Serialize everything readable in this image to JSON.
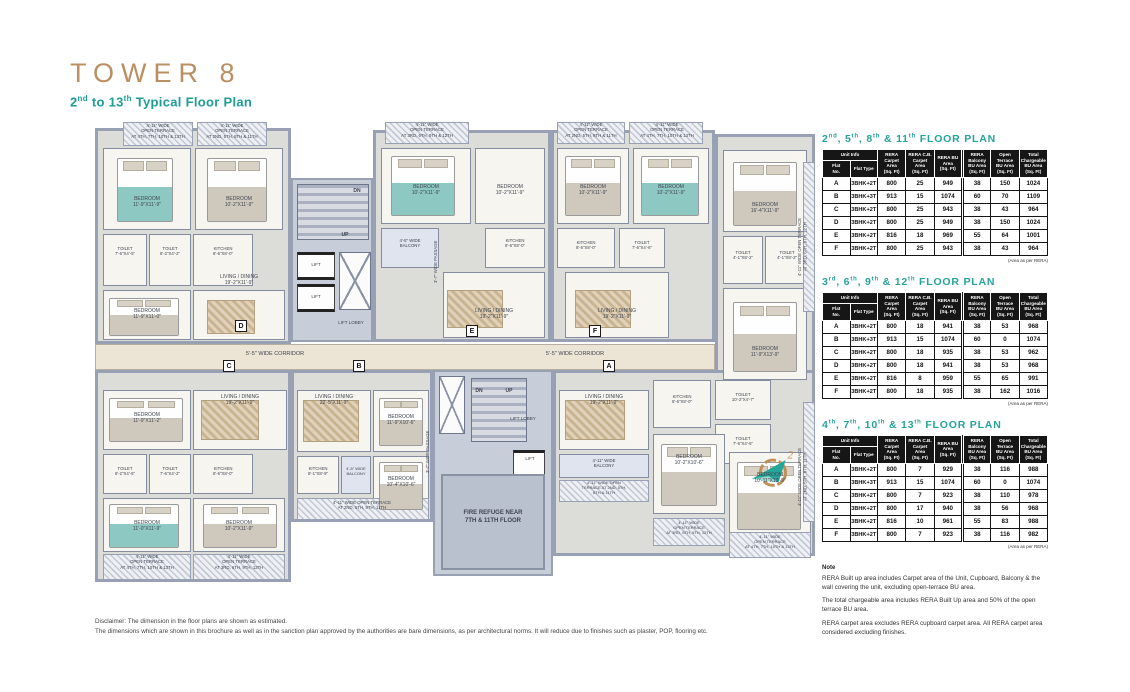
{
  "header": {
    "title": "TOWER 8",
    "subtitle_segments": [
      {
        "t": "2"
      },
      {
        "t": "nd",
        "sup": true
      },
      {
        "t": " to 13"
      },
      {
        "t": "th",
        "sup": true
      },
      {
        "t": " Typical Floor Plan"
      }
    ]
  },
  "floor_plan": {
    "unit_markers": [
      {
        "l": "D",
        "x": 140,
        "y": 198
      },
      {
        "l": "E",
        "x": 371,
        "y": 203
      },
      {
        "l": "F",
        "x": 494,
        "y": 203
      },
      {
        "l": "C",
        "x": 128,
        "y": 238
      },
      {
        "l": "B",
        "x": 258,
        "y": 238
      },
      {
        "l": "A",
        "x": 508,
        "y": 238
      }
    ],
    "labels": [
      {
        "t": "4'-11\" WIDE\nOPEN TERRACE\nAT 4TH, 7TH, 10TH & 13TH",
        "x": 28,
        "y": 1,
        "w": 70,
        "fs": 4.3
      },
      {
        "t": "4'-11\" WIDE\nOPEN TERRACE\nAT 2ND, 5TH, 8TH & 11TH",
        "x": 102,
        "y": 1,
        "w": 70,
        "fs": 4.3
      },
      {
        "t": "BEDROOM\n11'-9\"X11'-9\"",
        "x": 10,
        "y": 74,
        "w": 84
      },
      {
        "t": "BEDROOM\n10'-2\"X11'-9\"",
        "x": 102,
        "y": 74,
        "w": 84
      },
      {
        "t": "TOILET\n7'-6\"X4'-5\"",
        "x": 8,
        "y": 124,
        "w": 44,
        "fs": 4.3
      },
      {
        "t": "TOILET\n8'-2\"X4'-2\"",
        "x": 54,
        "y": 124,
        "w": 42,
        "fs": 4.3
      },
      {
        "t": "KITCHEN\n8'-6\"X8'-0\"",
        "x": 98,
        "y": 124,
        "w": 60,
        "fs": 4.3
      },
      {
        "t": "BEDROOM\n11'-9\"X11'-0\"",
        "x": 10,
        "y": 186,
        "w": 84
      },
      {
        "t": "LIVING / DINING\n19'-2\"X11'-9\"",
        "x": 98,
        "y": 152,
        "w": 92
      },
      {
        "t": "DN",
        "x": 252,
        "y": 66,
        "w": 20,
        "b": true
      },
      {
        "t": "UP",
        "x": 240,
        "y": 110,
        "w": 20,
        "b": true
      },
      {
        "t": "LIFT",
        "x": 202,
        "y": 140,
        "w": 38,
        "fs": 4.5
      },
      {
        "t": "LIFT",
        "x": 202,
        "y": 172,
        "w": 38,
        "fs": 4.5
      },
      {
        "t": "LIFT LOBBY",
        "x": 232,
        "y": 198,
        "w": 48,
        "fs": 4.5
      },
      {
        "t": "4'-11\" WIDE\nOPEN TERRACE\nAT 3RD, 6TH, 9TH & 12TH",
        "x": 288,
        "y": 0,
        "w": 88,
        "fs": 4.3
      },
      {
        "t": "BEDROOM\n10'-2\"X11'-9\"",
        "x": 288,
        "y": 62,
        "w": 86
      },
      {
        "t": "BEDROOM\n10'-2\"X11'-9\"",
        "x": 382,
        "y": 62,
        "w": 66
      },
      {
        "t": "4'-5\" WIDE\nBALCONY",
        "x": 286,
        "y": 116,
        "w": 58,
        "fs": 4.3
      },
      {
        "t": "KITCHEN\n8'-6\"X8'-0\"",
        "x": 390,
        "y": 116,
        "w": 60,
        "fs": 4.3
      },
      {
        "t": "LIVING / DINING\n19'-2\"X11'-9\"",
        "x": 348,
        "y": 186,
        "w": 102
      },
      {
        "t": "3'-7\" WIDE PASSAGE",
        "x": 338,
        "y": 100,
        "rot": true,
        "h": 80,
        "fs": 4.3
      },
      {
        "t": "4'-11\" WIDE\nOPEN TERRACE\nAT 2ND, 5TH, 8TH & 11TH",
        "x": 460,
        "y": 0,
        "w": 72,
        "fs": 4.3
      },
      {
        "t": "4'-11\" WIDE\nOPEN TERRACE\nAT 4TH, 7TH, 10TH & 13TH",
        "x": 534,
        "y": 0,
        "w": 76,
        "fs": 4.3
      },
      {
        "t": "BEDROOM\n10'-2\"X11'-9\"",
        "x": 464,
        "y": 62,
        "w": 68
      },
      {
        "t": "BEDROOM\n10'-2\"X11'-9\"",
        "x": 540,
        "y": 62,
        "w": 72
      },
      {
        "t": "KITCHEN\n8'-6\"X8'-0\"",
        "x": 462,
        "y": 118,
        "w": 58,
        "fs": 4.3
      },
      {
        "t": "TOILET\n7'-6\"X4'-6\"",
        "x": 524,
        "y": 118,
        "w": 46,
        "fs": 4.3
      },
      {
        "t": "LIVING / DINING\n19'-2\"X11'-9\"",
        "x": 470,
        "y": 186,
        "w": 104
      },
      {
        "t": "BEDROOM\n16'-4\"X11'-9\"",
        "x": 630,
        "y": 80,
        "w": 80
      },
      {
        "t": "TOILET\n4'-1\"X8'-2\"",
        "x": 628,
        "y": 128,
        "w": 40,
        "fs": 4.3
      },
      {
        "t": "TOILET\n4'-1\"X8'-2\"",
        "x": 670,
        "y": 128,
        "w": 44,
        "fs": 4.3
      },
      {
        "t": "BEDROOM\n11'-9\"X13'-9\"",
        "x": 630,
        "y": 224,
        "w": 80
      },
      {
        "t": "4'-11\" WIDE OPEN TERRACE\nAT 3RD, 6TH, 9TH, 12TH",
        "x": 702,
        "y": 60,
        "rot": true,
        "h": 130,
        "fs": 4.3
      },
      {
        "t": "5'-5\" WIDE CORRIDOR",
        "x": 120,
        "y": 229,
        "w": 120,
        "fs": 5.5
      },
      {
        "t": "5'-5\" WIDE CORRIDOR",
        "x": 420,
        "y": 229,
        "w": 120,
        "fs": 5.5
      },
      {
        "t": "BEDROOM\n11'-9\"X11'-2\"",
        "x": 10,
        "y": 290,
        "w": 84
      },
      {
        "t": "LIVING / DINING\n19'-2\"X11'-9\"",
        "x": 98,
        "y": 272,
        "w": 94
      },
      {
        "t": "TOILET\n8'-2\"X4'-5\"",
        "x": 8,
        "y": 344,
        "w": 44,
        "fs": 4.3
      },
      {
        "t": "TOILET\n7'-6\"X4'-2\"",
        "x": 54,
        "y": 344,
        "w": 42,
        "fs": 4.3
      },
      {
        "t": "KITCHEN\n8'-6\"X8'-0\"",
        "x": 98,
        "y": 344,
        "w": 60,
        "fs": 4.3
      },
      {
        "t": "BEDROOM\n11'-0\"X11'-9\"",
        "x": 10,
        "y": 398,
        "w": 84
      },
      {
        "t": "BEDROOM\n10'-2\"X11'-9\"",
        "x": 98,
        "y": 398,
        "w": 92
      },
      {
        "t": "4'-11\" WIDE\nOPEN TERRACE\nAT 4TH, 7TH, 10TH & 13TH",
        "x": 8,
        "y": 432,
        "w": 88,
        "fs": 4.3
      },
      {
        "t": "4'-11\" WIDE\nOPEN TERRACE\nAT 3RD, 6TH, 9TH, 12TH",
        "x": 98,
        "y": 432,
        "w": 92,
        "fs": 4.3
      },
      {
        "t": "LIVING / DINING\n22'-5\"X11'-9\"",
        "x": 200,
        "y": 272,
        "w": 78
      },
      {
        "t": "BEDROOM\n11'-9\"X10'-6\"",
        "x": 276,
        "y": 292,
        "w": 60
      },
      {
        "t": "KITCHEN\n8'-1\"X8'-9\"",
        "x": 200,
        "y": 344,
        "w": 46,
        "fs": 4.3
      },
      {
        "t": "4'-5\" WIDE\nBALCONY",
        "x": 244,
        "y": 344,
        "w": 34,
        "fs": 4
      },
      {
        "t": "BEDROOM\n10'-4\"X10'-6\"",
        "x": 276,
        "y": 354,
        "w": 60
      },
      {
        "t": "4'-11\" WIDE OPEN TERRACE\nAT 2ND, 5TH, 8TH, 11TH",
        "x": 200,
        "y": 378,
        "w": 134,
        "fs": 4.3
      },
      {
        "t": "3'-7\" WIDE PASSAGE",
        "x": 330,
        "y": 290,
        "rot": true,
        "h": 80,
        "fs": 4.3
      },
      {
        "t": "DN",
        "x": 374,
        "y": 266,
        "w": 20,
        "b": true
      },
      {
        "t": "UP",
        "x": 404,
        "y": 266,
        "w": 20,
        "b": true
      },
      {
        "t": "LIFT LOBBY",
        "x": 400,
        "y": 294,
        "w": 56,
        "fs": 4.5
      },
      {
        "t": "LIFT",
        "x": 420,
        "y": 334,
        "w": 30,
        "fs": 4.5
      },
      {
        "t": "FIRE REFUGE NEAR\n7TH & 11TH FLOOR",
        "x": 356,
        "y": 388,
        "w": 84,
        "fs": 6,
        "b": true
      },
      {
        "t": "LIVING / DINING\n19'-2\"X11'-9\"",
        "x": 462,
        "y": 272,
        "w": 94
      },
      {
        "t": "KITCHEN\n8'-6\"X8'-0\"",
        "x": 558,
        "y": 272,
        "w": 58,
        "fs": 4.3
      },
      {
        "t": "TOILET\n10'-2\"X4'-7\"",
        "x": 620,
        "y": 270,
        "w": 56,
        "fs": 4.3
      },
      {
        "t": "TOILET\n7'-6\"X4'-6\"",
        "x": 620,
        "y": 314,
        "w": 56,
        "fs": 4.3
      },
      {
        "t": "4'-11\" WIDE\nBALCONY",
        "x": 466,
        "y": 336,
        "w": 86,
        "fs": 4.3
      },
      {
        "t": "4'-11\" WIDE OPEN\nTERRACE AT 2ND, 5TH,\n8TH & 11TH",
        "x": 466,
        "y": 358,
        "w": 86,
        "fs": 4
      },
      {
        "t": "BEDROOM\n10'-2\"X10'-6\"",
        "x": 560,
        "y": 332,
        "w": 68
      },
      {
        "t": "BEDROOM\n10'-11\"X13'-9\"",
        "x": 636,
        "y": 350,
        "w": 78
      },
      {
        "t": "4'-11\" WIDE\nOPEN TERRACE\nAT 3RD, 6TH, 9TH, 12TH",
        "x": 558,
        "y": 398,
        "w": 72,
        "fs": 4
      },
      {
        "t": "4'-11\" WIDE\nOPEN TERRACE\nAT 4TH, 7TH, 10TH & 13TH",
        "x": 634,
        "y": 412,
        "w": 82,
        "fs": 4
      },
      {
        "t": "4'-11\" WIDE OPEN TERRACE\nAT 2ND, 5TH, 8TH, 11TH",
        "x": 702,
        "y": 290,
        "rot": true,
        "h": 130,
        "fs": 4.3
      }
    ]
  },
  "table_headers": {
    "unit_info": "Unit Info",
    "flat_no": "Flat\nNo.",
    "flat_type": "Flat Type",
    "area_cols": [
      "RERA Carpet\nArea\n(Sq. Ft)",
      "RERA C.B.\nCarpet Area\n(Sq. Ft)",
      "RERA BU\nArea\n(Sq. Ft)",
      "RERA\nBalcony\nBU Area\n(Sq. Ft)",
      "Open\nTerrace\nBU Area\n(Sq. Ft)",
      "Total\nChargeable\nBU Area\n(Sq. Ft)"
    ]
  },
  "tables": [
    {
      "title_segments": [
        {
          "t": "2"
        },
        {
          "t": "nd",
          "sup": true
        },
        {
          "t": ", 5"
        },
        {
          "t": "th",
          "sup": true
        },
        {
          "t": ", 8"
        },
        {
          "t": "th",
          "sup": true
        },
        {
          "t": " & 11"
        },
        {
          "t": "th",
          "sup": true
        },
        {
          "t": " FLOOR PLAN"
        }
      ],
      "rows": [
        [
          "A",
          "3BHK+2T",
          "800",
          "25",
          "949",
          "38",
          "150",
          "1024"
        ],
        [
          "B",
          "3BHK+3T",
          "913",
          "15",
          "1074",
          "60",
          "70",
          "1109"
        ],
        [
          "C",
          "3BHK+2T",
          "800",
          "25",
          "943",
          "38",
          "43",
          "964"
        ],
        [
          "D",
          "3BHK+2T",
          "800",
          "25",
          "949",
          "38",
          "150",
          "1024"
        ],
        [
          "E",
          "3BHK+2T",
          "816",
          "18",
          "969",
          "55",
          "64",
          "1001"
        ],
        [
          "F",
          "3BHK+2T",
          "800",
          "25",
          "943",
          "38",
          "43",
          "964"
        ]
      ],
      "footnote": "(Area as per RERA)"
    },
    {
      "title_segments": [
        {
          "t": "3"
        },
        {
          "t": "rd",
          "sup": true
        },
        {
          "t": ", 6"
        },
        {
          "t": "th",
          "sup": true
        },
        {
          "t": ", 9"
        },
        {
          "t": "th",
          "sup": true
        },
        {
          "t": " & 12"
        },
        {
          "t": "th",
          "sup": true
        },
        {
          "t": " FLOOR PLAN"
        }
      ],
      "rows": [
        [
          "A",
          "3BHK+2T",
          "800",
          "18",
          "941",
          "38",
          "53",
          "968"
        ],
        [
          "B",
          "3BHK+3T",
          "913",
          "15",
          "1074",
          "60",
          "0",
          "1074"
        ],
        [
          "C",
          "3BHK+2T",
          "800",
          "18",
          "935",
          "38",
          "53",
          "962"
        ],
        [
          "D",
          "3BHK+2T",
          "800",
          "18",
          "941",
          "38",
          "53",
          "968"
        ],
        [
          "E",
          "3BHK+2T",
          "816",
          "8",
          "959",
          "55",
          "65",
          "991"
        ],
        [
          "F",
          "3BHK+2T",
          "800",
          "18",
          "935",
          "38",
          "162",
          "1016"
        ]
      ],
      "footnote": "(Area as per RERA)"
    },
    {
      "title_segments": [
        {
          "t": "4"
        },
        {
          "t": "th",
          "sup": true
        },
        {
          "t": ", 7"
        },
        {
          "t": "th",
          "sup": true
        },
        {
          "t": ", 10"
        },
        {
          "t": "th",
          "sup": true
        },
        {
          "t": " & 13"
        },
        {
          "t": "th",
          "sup": true
        },
        {
          "t": " FLOOR PLAN"
        }
      ],
      "rows": [
        [
          "A",
          "3BHK+2T",
          "800",
          "7",
          "929",
          "38",
          "116",
          "988"
        ],
        [
          "B",
          "3BHK+3T",
          "913",
          "15",
          "1074",
          "60",
          "0",
          "1074"
        ],
        [
          "C",
          "3BHK+2T",
          "800",
          "7",
          "923",
          "38",
          "110",
          "978"
        ],
        [
          "D",
          "3BHK+2T",
          "800",
          "17",
          "940",
          "38",
          "56",
          "968"
        ],
        [
          "E",
          "3BHK+2T",
          "816",
          "10",
          "961",
          "55",
          "83",
          "988"
        ],
        [
          "F",
          "3BHK+2T",
          "800",
          "7",
          "923",
          "38",
          "116",
          "982"
        ]
      ],
      "footnote": "(Area as per RERA)"
    }
  ],
  "note": {
    "title": "Note",
    "lines": [
      "RERA Built up area includes Carpet area of the Unit, Cupboard, Balcony & the wall covering the unit, excluding open-terrace BU area.",
      "The total chargeable area includes RERA Built Up area and 50% of the open terrace BU area.",
      "RERA carpet area excludes RERA cupboard carpet area. All RERA carpet area considered excluding finishes."
    ]
  },
  "disclaimer": {
    "line1": "Disclaimer: The dimension in the floor plans are shown as estimated.",
    "line2": "The dimensions which are shown in this brochure as well as in the sanction plan approved by the authorities are bare dimensions, as per architectural norms. It will reduce due to finishes such as plaster, POP, flooring etc."
  }
}
